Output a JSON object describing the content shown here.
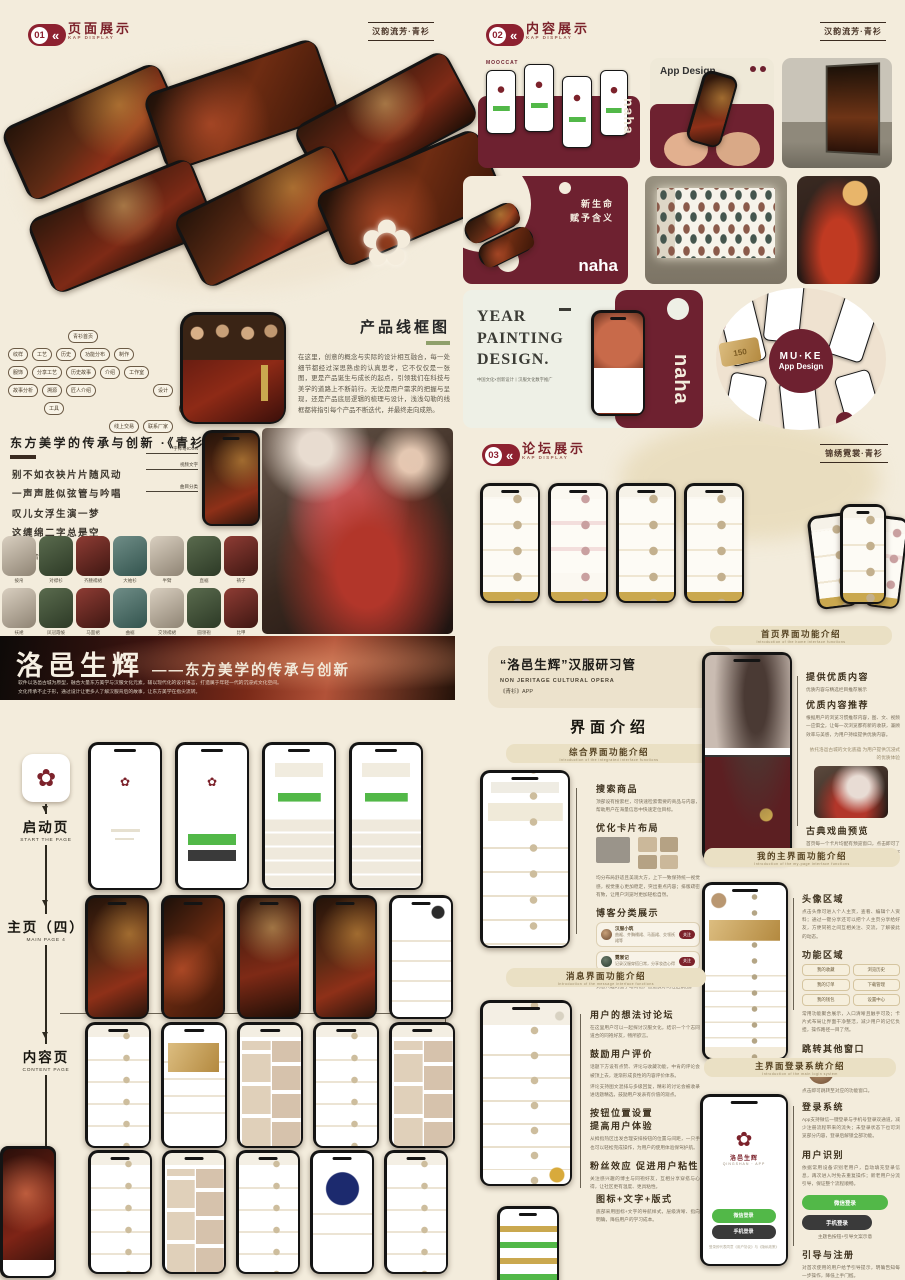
{
  "icons": {
    "flower": "✿",
    "arrows": "«",
    "dash": "——"
  },
  "headers": {
    "h01": {
      "num": "01",
      "title": "页面展示",
      "sub": "KAP DISPLAY",
      "tag": "汉韵流芳·青衫"
    },
    "h02": {
      "num": "02",
      "title": "内容展示",
      "sub": "KAP DISPLAY",
      "tag": "汉韵流芳·青衫"
    },
    "h03": {
      "num": "03",
      "title": "论坛展示",
      "sub": "KAP DISPLAY",
      "tag": "锦绣霓裳·青衫"
    }
  },
  "wireframe": {
    "title": "产品线框图",
    "body": "在这里，创意的概念与实际的设计相互融合，每一处细节都经过深思熟虑的认真思考，它不仅仅是一张图，更是产品诞生与成长的起点，引领我们在科技与美学的道路上不断前行。无论是用户需求的把握与呈现，还是产品底层逻辑的梳理与设计，浅浅勾勒的线框都将指引每个产品不断迭代，并最终走向成熟。",
    "rows": {
      "r0": [
        "青衫首页"
      ],
      "r1": [
        "纹样",
        "工艺",
        "历史",
        "功能分布",
        "制作"
      ],
      "r2": [
        "服饰",
        "分享工艺",
        "历史故事",
        "介绍",
        "工作室"
      ],
      "r3": [
        "故事分析",
        "溯源",
        "匠人介绍",
        "设计"
      ],
      "r4": [
        "工具",
        "图案组合"
      ],
      "r5": [
        "线上交易",
        "联系厂家"
      ]
    }
  },
  "aesthetics": {
    "title": "东方美学的传承与创新 ·《青衫》",
    "poem": [
      "别不如衣袂片片随风动",
      "一声声胜似弦管与吟唱",
      "叹儿女浮生演一梦",
      "这缠绵二字总是空"
    ],
    "source": "京剧《青衫》",
    "callouts": [
      "字体与ICON",
      "视频文字",
      "曲目分类"
    ]
  },
  "clothing": {
    "row1": [
      "披帛",
      "对襟衫",
      "齐腰襦裙",
      "大袖衫",
      "半臂",
      "直裾",
      "褙子"
    ],
    "row2": [
      "袄裙",
      "凤冠霞帔",
      "马面裙",
      "曲裾",
      "交领襦裙",
      "圆领袍",
      "比甲"
    ]
  },
  "banner": {
    "title": "洛邑生辉",
    "subtitle": "——东方美学的传承与创新",
    "line1": "软件以洛邑古城为原型，融合大量东方美学与汉服文化元素，辅以现代化的设计语言，打造属于年轻一代的沉浸式文化空间。",
    "line2": "文化传承不止于形，通过设计让更多人了解汉服背后的故事，让东方美学在指尖流转。"
  },
  "flow": {
    "s1": "启动页",
    "s1en": "START THE PAGE",
    "s2": "主页（四）",
    "s2en": "MAIN PAGE 4",
    "s3": "内容页",
    "s3en": "CONTENT PAGE"
  },
  "showcase": {
    "mooccat": "MOOCCAT",
    "naha": "naha",
    "appdesign": "App Design",
    "newlife1": "新生命",
    "newlife2": "赋予含义",
    "year": [
      "YEAR",
      "PAINTING",
      "DESIGN."
    ],
    "year_cap": "中国文化×创新设计丨汉服文化数字推广",
    "muke1": "MU·KE",
    "muke2": "App Design",
    "card150": "150"
  },
  "research": {
    "title": "“洛邑生辉”汉服研习管",
    "en": "NON JERITAGE CULTURAL OPERA",
    "app": "《青衫》APP",
    "intro": "界面介绍"
  },
  "pills": {
    "home": {
      "t": "首页界面功能介绍",
      "s": "Introduction of the home interface functions"
    },
    "comp": {
      "t": "综合界面功能介绍",
      "s": "Introduction of the integrated interface functions"
    },
    "msg": {
      "t": "消息界面功能介绍",
      "s": "Introduction of the message interface functions"
    },
    "mine": {
      "t": "我的主界面功能介绍",
      "s": "Introduction of the my-page interface functions"
    },
    "login": {
      "t": "主界面登录系统介绍",
      "s": "Introduction of the main login system"
    }
  },
  "home": {
    "a1": "提供优质内容",
    "a1b": "优质内容与精选栏目推荐展示",
    "a2": "优质内容推荐",
    "a2b": "根据用户的浏览习惯推荐内容，图、文、视频一应俱全，让每一次浏览都有新的收获，兼顾效率与美感，为用户持续提供优质内容。",
    "a2note": "依托洛邑古城的文化底蕴 为用户提供沉浸式的优质体验",
    "a3": "古典戏曲预览",
    "a3b": "首页每一个卡片均配有预览窗口，点击即可了解更多剧目详情，也可以一键收藏或分享给好友。"
  },
  "comp": {
    "a1": "搜索商品",
    "a1b": "顶部设有搜索栏，可快速检索需要的商品与内容，帮助用户在海量信息中快速定位目标。",
    "a2": "优化卡片布局",
    "a2b": "均分布局舒适且美观大方，上下一致保持统一视觉感，视觉重心更加稳定，突出重点内容；排版疏密有致，让用户浏览时更加轻松自然。",
    "a3": "博客分类展示",
    "a3b": "个性化、兴趣化的博客分类展示，帮助用户快速找到感兴趣的圈子与同袍，营造良好的社区氛围。",
    "card1": {
      "name": "汉服小筑",
      "text": "曲裾、齐胸襦裙、马面裙、交领袄裙等",
      "btn": "关注"
    },
    "card2": {
      "name": "霓裳记",
      "text": "记录汉服穿搭日常，分享妆造心得",
      "btn": "关注"
    }
  },
  "msg": {
    "a1": "用户的想法讨论坛",
    "a1b": "在这里用户可以一起探讨汉服文化，结识一个个志同道合的同袍好友，畅所欲言。",
    "a2": "鼓励用户评价",
    "a2b": "话题下方设有点赞、评论与收藏功能，中肯的评论会被顶上去，逐渐形成良性的内容评价体系。",
    "a2b2": "评论支持图文混排与多级回复，精彩的讨论会被收录进话题精选，鼓励用户发表有价值的观点。",
    "a3": "按钮位置设置",
    "a3t2": "提高用户体验",
    "a3b": "从拇指热区出发合理安排按钮的位置与间距，一只手也可以轻松完成操作，为用户的使用体验保驾护航。",
    "a4": "粉丝效应 促进用户粘性",
    "a4b": "关注感兴趣的博主与同袍好友，互相分享穿搭与心得，让社区更有温度、更具粘性。",
    "a5": "图标+文字+版式",
    "a5b": "底部采用图标+文字的导航样式，层级清晰、指向明确，降低用户的学习成本。"
  },
  "mine": {
    "a1": "头像区域",
    "a1b": "点击头像可进入个人主页，查看、编辑个人资料；通过一键分享还可以把个人主页分享给好友，方便同袍之间互相关注、交流，了解彼此的动态。",
    "a2": "功能区域",
    "items": [
      "我的收藏",
      "浏览历史",
      "我的订单",
      "下载管理",
      "我的钱包",
      "设置中心"
    ],
    "a2b": "常用功能聚合展示，入口清晰且触手可及；卡片式布局让界面干净整洁，减少用户的记忆负担，操作路径一目了然。",
    "a3": "跳转其他窗口",
    "a3b": "点击即可跳转至对应的功能窗口。"
  },
  "login": {
    "a1": "登录系统",
    "a1b": "App支持微信一键登录与手机号登录双通道，减少注册流程带来的流失；未登录状态下也可浏览部分内容，登录后解锁全部功能。",
    "a2": "用户识别",
    "a2b": "依据常用设备识别老用户，自动填充登录信息，再次进入时免去重复操作；新老用户分流引导，保证整个流程顺畅。",
    "btn_green": "微信登录",
    "btn_dark": "手机登录",
    "btn_cap": "主题色按钮+引导文案示意",
    "a3": "引导与注册",
    "a3b": "对首次使用的用户给予引导提示，明确告知每一步操作，降低上手门槛。",
    "phone_name": "洛邑生辉",
    "phone_sub": "QINGSHAN · APP",
    "note": "登录即代表同意《用户协议》与《隐私政策》"
  }
}
